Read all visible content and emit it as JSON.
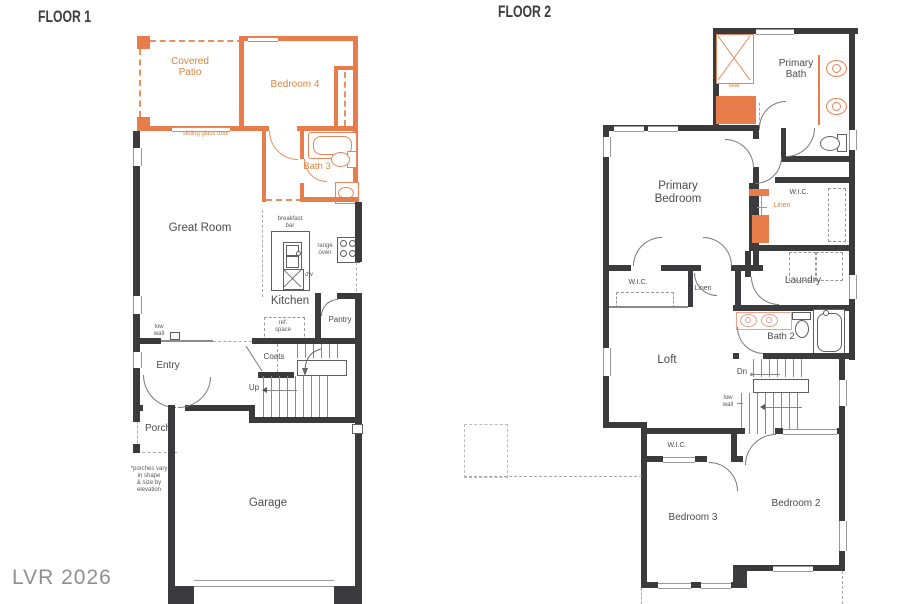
{
  "colors": {
    "wall": "#3b3b3d",
    "orange": "#e87c4a",
    "orange_text": "#de853e",
    "pink_fixture": "#e9a28e",
    "label_text": "#4c4c4c"
  },
  "watermark": "LVR 2026",
  "floor1": {
    "title": "FLOOR 1",
    "labels": {
      "covered_patio": "Covered\nPatio",
      "bedroom4": "Bedroom 4",
      "sliding_glass_door": "sliding glass door",
      "bath3": "Bath 3",
      "great_room": "Great Room",
      "breakfast_bar": "breakfast\nbar",
      "range_oven": "range\noven",
      "dw": "dw",
      "kitchen": "Kitchen",
      "ref_space": "ref.\nspace",
      "pantry": "Pantry",
      "low_wall": "low\nwall",
      "entry": "Entry",
      "coats": "Coats",
      "up": "Up",
      "porch": "Porch",
      "porch_note": "*porches vary\nin shape\n& size by\nelevation",
      "garage": "Garage"
    }
  },
  "floor2": {
    "title": "FLOOR 2",
    "labels": {
      "primary_bath": "Primary\nBath",
      "seat": "seat",
      "primary_bedroom": "Primary\nBedroom",
      "wic_primary": "W.I.C.",
      "linen_primary": "Linen",
      "laundry": "Laundry",
      "wic_hall": "W.I.C.",
      "linen_hall": "Linen",
      "bath2": "Bath 2",
      "loft": "Loft",
      "dn": "Dn",
      "low_wall": "low\nwall",
      "wic_bedroom3": "W.I.C.",
      "bedroom3": "Bedroom 3",
      "bedroom2": "Bedroom 2"
    }
  }
}
